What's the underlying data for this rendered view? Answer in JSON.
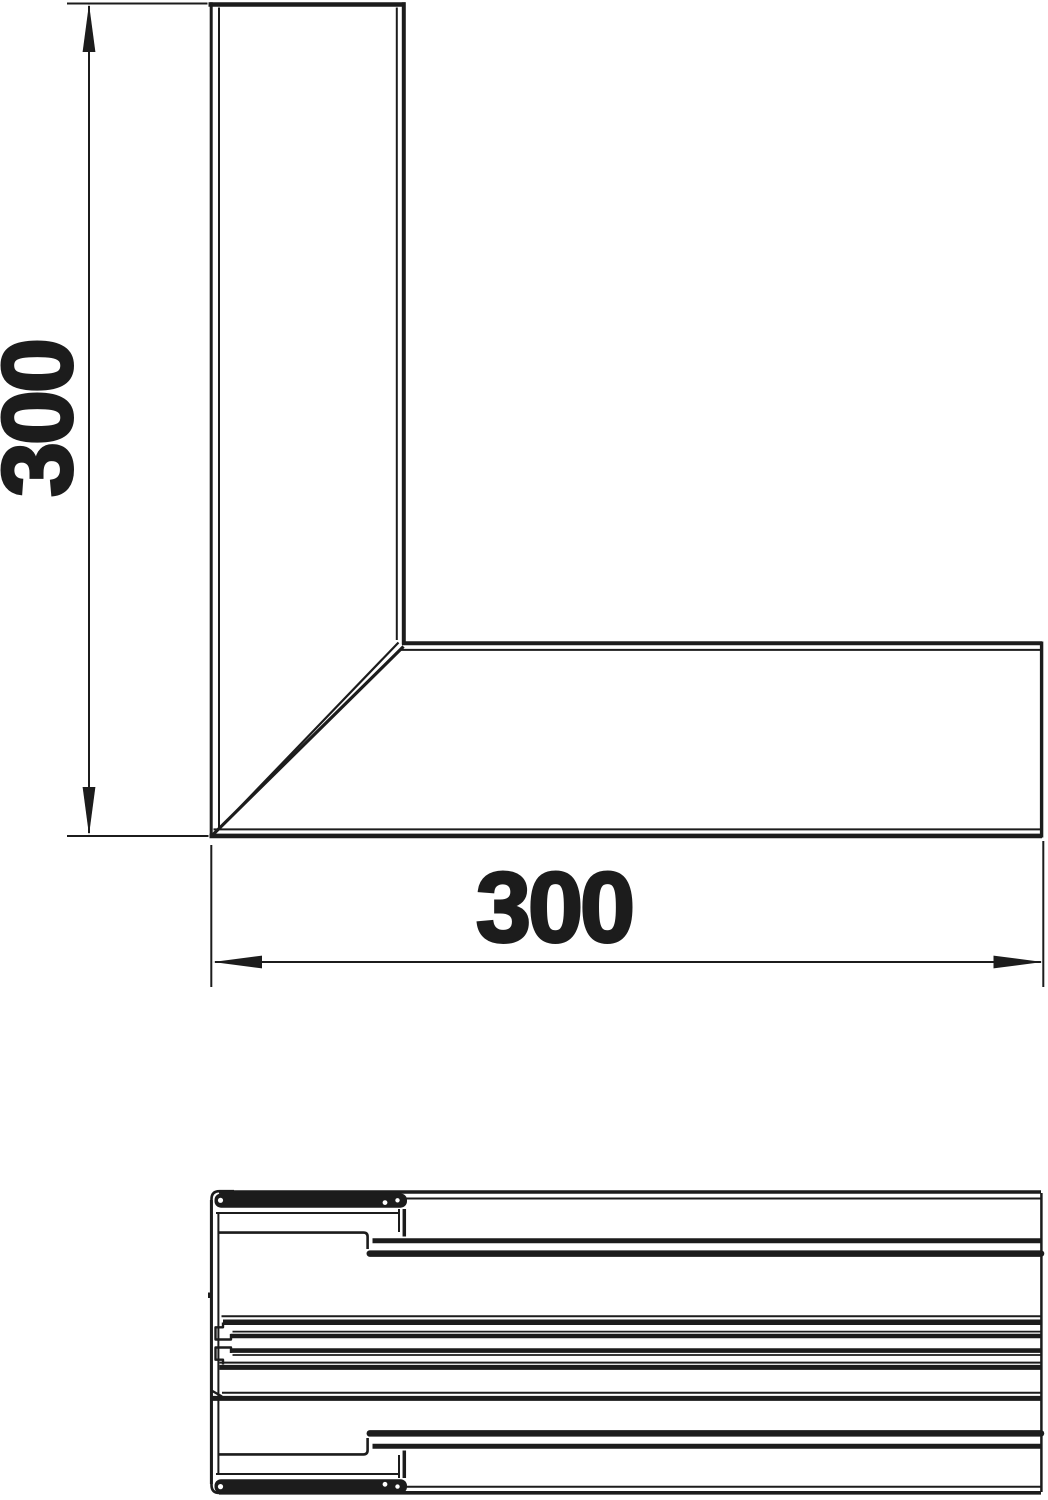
{
  "drawing": {
    "background": "#ffffff",
    "line_color": "#1c1c1c",
    "top_view": {
      "dimensions": {
        "vertical": "300",
        "horizontal": "300"
      }
    }
  }
}
